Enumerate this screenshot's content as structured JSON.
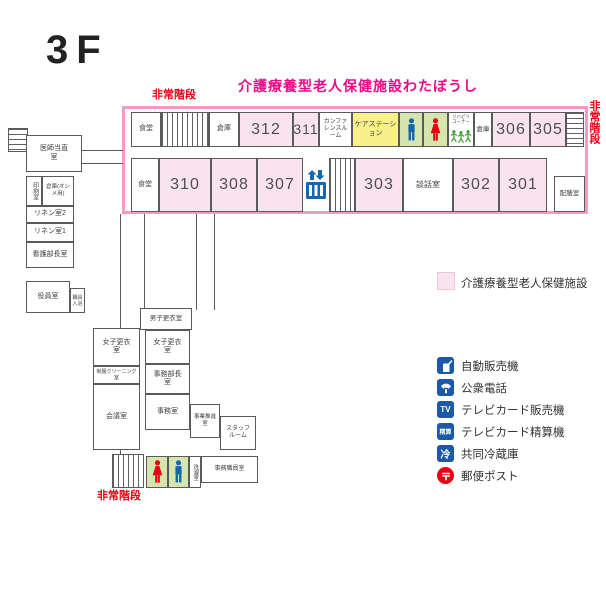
{
  "floor_title": "3F",
  "facility_banner": "介護療養型老人保健施設わたぼうし",
  "emergency_stairs": {
    "top": "非常階段",
    "right": "非常階段",
    "bottom": "非常階段"
  },
  "main_wing": {
    "top_row": {
      "dining": "食堂",
      "storage_left": "倉庫",
      "room_312": "312",
      "room_311": "311",
      "conference_room": "カンファレンスルーム",
      "care_station": "ケアステーション",
      "rehab_corner": "リハビリコーナー",
      "storage_right": "倉庫",
      "room_306": "306",
      "room_305": "305"
    },
    "bottom_row": {
      "dining": "食堂",
      "room_310": "310",
      "room_308": "308",
      "room_307": "307",
      "room_303": "303",
      "lounge": "談話室",
      "room_302": "302",
      "room_301": "301",
      "serving_room": "配膳室"
    }
  },
  "west_wing": {
    "doctor_duty_room": "医師当直室",
    "printing_room": "印刷室",
    "storage_diapers": "倉庫(オシメ用)",
    "linen_room_2": "リネン室2",
    "linen_room_1": "リネン室1",
    "nursing_director_room": "看護部長室",
    "executive_room": "役員室",
    "staff_bath_room": "職員入浴"
  },
  "south_wing": {
    "mens_locker_room": "男子更衣室",
    "womens_locker_room_west": "女子更衣室",
    "uniform_cleaning_room": "制服クリーニング室",
    "womens_locker_room": "女子更衣室",
    "admin_director_room": "事務部長室",
    "meeting_room": "会議室",
    "office_room": "事務室",
    "business_promotion_room": "事業推進室",
    "staff_room": "スタッフルーム",
    "laundry_room": "洗濯室",
    "office_staff_room": "事務職員室"
  },
  "legend": {
    "area_swatch_label": "介護療養型老人保健施設",
    "items": [
      {
        "name": "vending-machine",
        "glyph": "",
        "label": "自動販売機"
      },
      {
        "name": "public-phone",
        "glyph": "",
        "label": "公衆電話"
      },
      {
        "name": "tv-card-vending-machine",
        "glyph": "TV",
        "label": "テレビカード販売機"
      },
      {
        "name": "tv-card-fare-adjuster",
        "glyph": "精算",
        "label": "テレビカード精算機"
      },
      {
        "name": "shared-refrigerator",
        "glyph": "冷",
        "label": "共同冷蔵庫"
      },
      {
        "name": "mail-post",
        "glyph": "〒",
        "label": "郵便ポスト"
      }
    ]
  },
  "colors": {
    "facility_pink": "#f9e3ee",
    "facility_border_pink": "#f19cc4",
    "care_station_yellow": "#f8f089",
    "toilet_green": "#d5e5ad",
    "icon_blue": "#1a5aa6",
    "figure_blue": "#1565b5",
    "alert_red": "#e60012",
    "banner_magenta": "#ea0a8a"
  }
}
